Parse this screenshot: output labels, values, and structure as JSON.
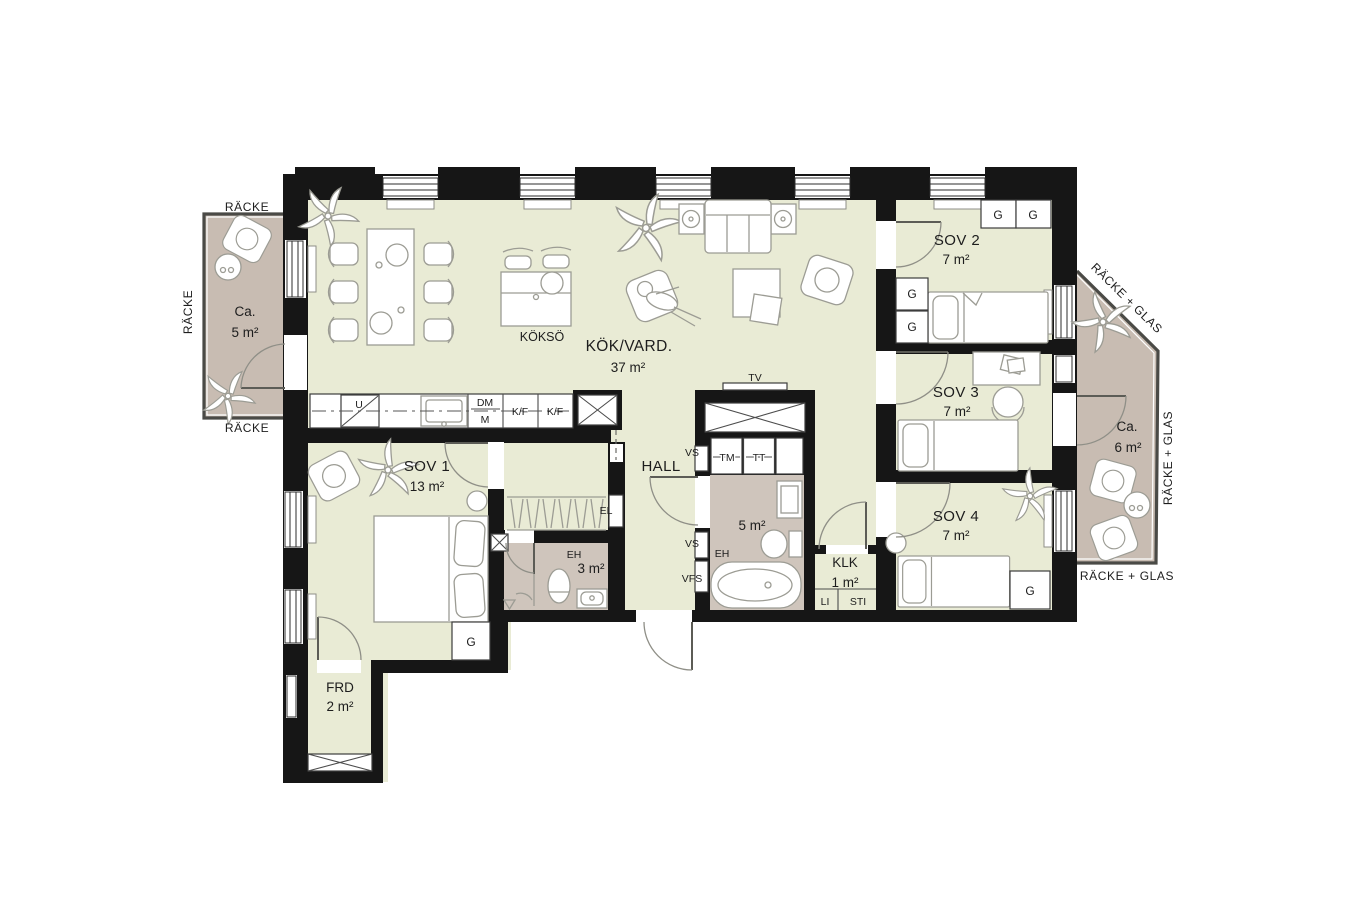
{
  "colors": {
    "wall-color": "#161616",
    "floor-color": "#e9ebd5",
    "balcony-color": "#c8bcb2",
    "wet-color": "#cfc5bc",
    "furniture-line": "#9c9c94",
    "text-color": "#1d1d1d"
  },
  "rooms": {
    "kitchen_living": {
      "name": "KÖK/VARD.",
      "area": "37 m²"
    },
    "kitchen_island": {
      "name": "KÖKSÖ"
    },
    "bedroom1": {
      "name": "SOV 1",
      "area": "13 m²"
    },
    "bedroom2": {
      "name": "SOV 2",
      "area": "7 m²"
    },
    "bedroom3": {
      "name": "SOV 3",
      "area": "7 m²"
    },
    "bedroom4": {
      "name": "SOV 4",
      "area": "7 m²"
    },
    "hall": {
      "name": "HALL"
    },
    "bathroom_large": {
      "label": "EH",
      "area": "5 m²"
    },
    "bathroom_small": {
      "label": "EH",
      "area": "3 m²"
    },
    "closet_room": {
      "name": "KLK",
      "area": "1 m²"
    },
    "storage": {
      "name": "FRD",
      "area": "2 m²"
    },
    "balcony_left": {
      "prefix": "Ca.",
      "area": "5 m²",
      "railing": "RÄCKE"
    },
    "balcony_right": {
      "prefix": "Ca.",
      "area": "6 m²",
      "railing": "RÄCKE + GLAS"
    }
  },
  "fixtures": {
    "tv": "TV",
    "electrical": "EL",
    "shaft_vs": "VS",
    "shaft_vfs": "VFS",
    "washer": "TM",
    "dryer": "TT",
    "linen": "LI",
    "cleaning": "STI",
    "closet": "G",
    "oven": "U",
    "dishwasher": "DM",
    "micro": "M",
    "fridge_freezer": "K/F"
  }
}
